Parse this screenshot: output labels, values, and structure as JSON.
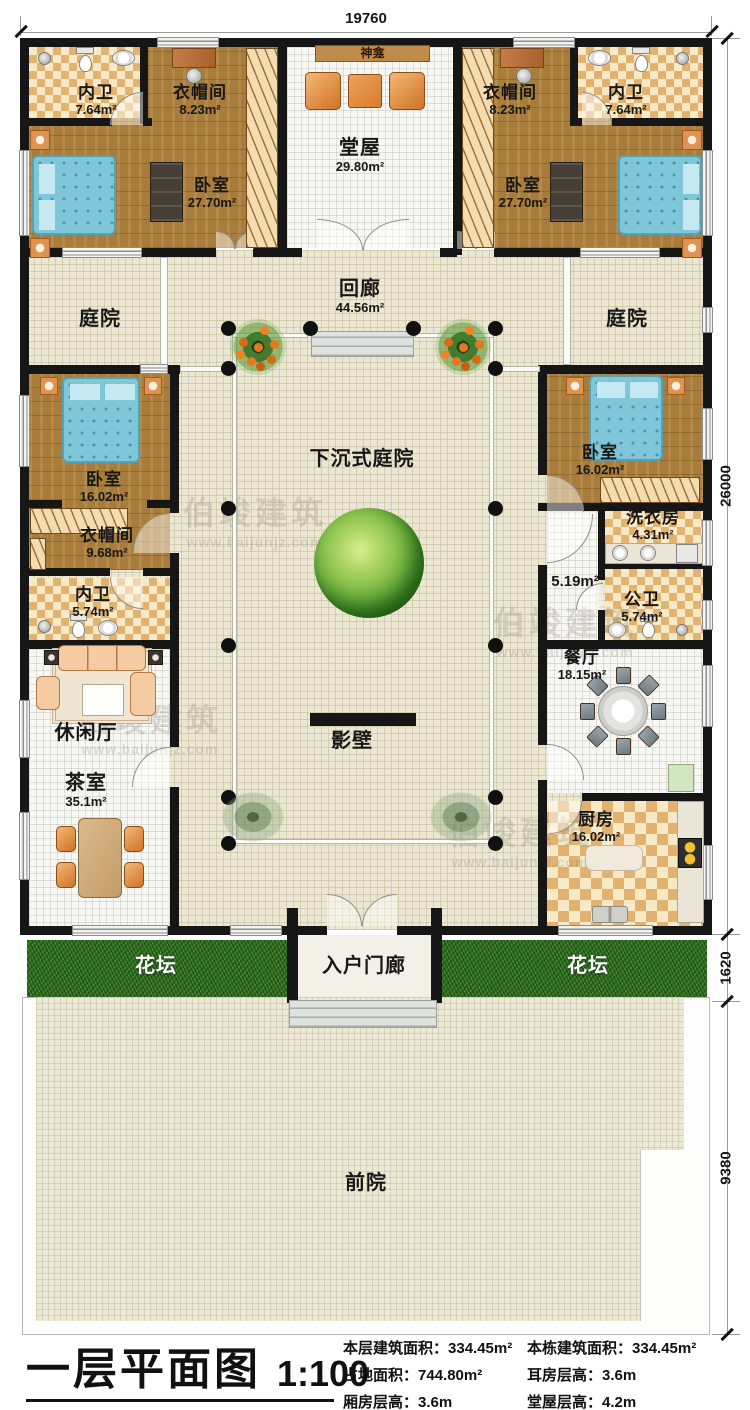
{
  "meta": {
    "title": "一层平面图",
    "scale": "1:100"
  },
  "dimensions": {
    "top": "19760",
    "side_main": "26000",
    "side_flowerbed": "1620",
    "side_frontyard": "9380"
  },
  "rooms": {
    "bath_tl": {
      "name": "内卫",
      "area": "7.64m²"
    },
    "closet_tl": {
      "name": "衣帽间",
      "area": "8.23m²"
    },
    "bedroom_tl": {
      "name": "卧室",
      "area": "27.70m²"
    },
    "hall": {
      "name": "堂屋",
      "area": "29.80m²"
    },
    "shrine": {
      "name": "神龛"
    },
    "closet_tr": {
      "name": "衣帽间",
      "area": "8.23m²"
    },
    "bath_tr": {
      "name": "内卫",
      "area": "7.64m²"
    },
    "bedroom_tr": {
      "name": "卧室",
      "area": "27.70m²"
    },
    "courtyard_left": {
      "name": "庭院"
    },
    "courtyard_right": {
      "name": "庭院"
    },
    "corridor": {
      "name": "回廊",
      "area": "44.56m²"
    },
    "bedroom_ml": {
      "name": "卧室",
      "area": "16.02m²"
    },
    "bedroom_mr": {
      "name": "卧室",
      "area": "16.02m²"
    },
    "sunken_courtyard": {
      "name": "下沉式庭院"
    },
    "closet_left": {
      "name": "衣帽间",
      "area": "9.68m²"
    },
    "bath_left": {
      "name": "内卫",
      "area": "5.74m²"
    },
    "laundry": {
      "name": "洗衣房",
      "area": "4.31m²"
    },
    "hallway": {
      "area": "5.19m²"
    },
    "public_bath": {
      "name": "公卫",
      "area": "5.74m²"
    },
    "lounge": {
      "name": "休闲厅"
    },
    "tea_room": {
      "name": "茶室",
      "area": "35.1m²"
    },
    "dining": {
      "name": "餐厅",
      "area": "18.15m²"
    },
    "screen_wall": {
      "name": "影壁"
    },
    "kitchen": {
      "name": "厨房",
      "area": "16.02m²"
    },
    "flowerbed_left": {
      "name": "花坛"
    },
    "flowerbed_right": {
      "name": "花坛"
    },
    "entry_porch": {
      "name": "入户门廊"
    },
    "front_yard": {
      "name": "前院"
    }
  },
  "stats": [
    {
      "label": "本层建筑面积：",
      "value": "334.45m²"
    },
    {
      "label": "本栋建筑面积：",
      "value": "334.45m²"
    },
    {
      "label": "占地面积：",
      "value": "744.80m²"
    },
    {
      "label": "耳房层高：",
      "value": "3.6m"
    },
    {
      "label": "厢房层高：",
      "value": "3.6m"
    },
    {
      "label": "堂屋层高：",
      "value": "4.2m"
    }
  ],
  "watermark": {
    "brand": "伯竣建筑",
    "url": "www.baijunjz.com"
  }
}
